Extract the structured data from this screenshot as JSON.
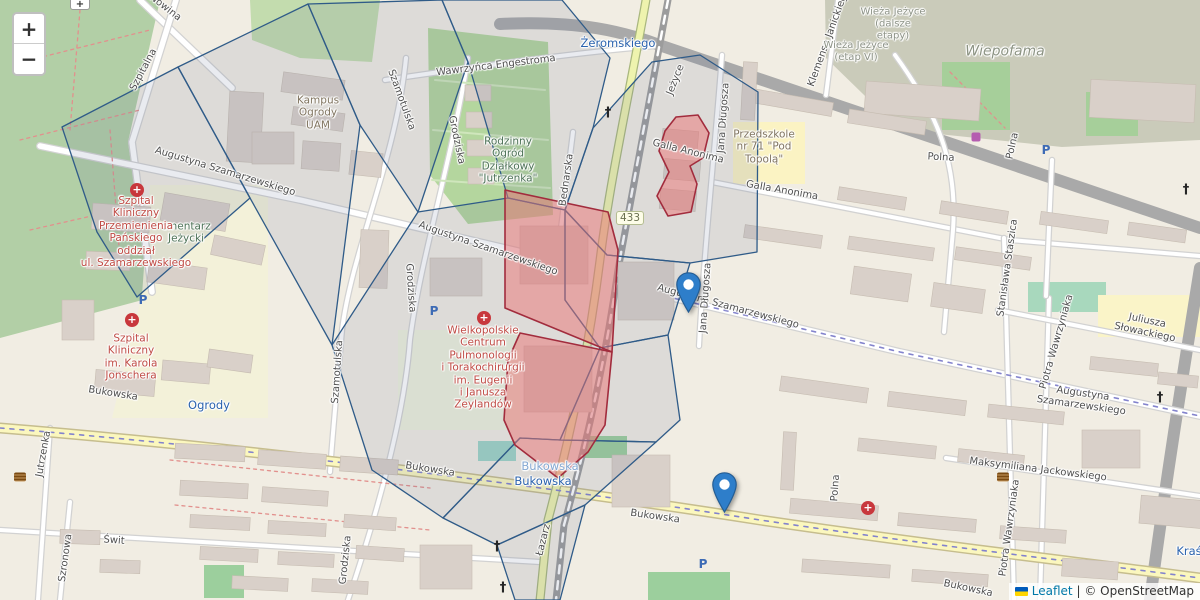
{
  "map": {
    "width": 1200,
    "height": 600
  },
  "controls": {
    "zoom_in_label": "+",
    "zoom_out_label": "−"
  },
  "attribution": {
    "flag_top": "#005bbb",
    "flag_bottom": "#ffd500",
    "leaflet_label": "Leaflet",
    "separator": "|",
    "copyright_label": "© OpenStreetMap"
  },
  "road_shield": {
    "text": "433",
    "x": 630,
    "y": 218
  },
  "markers": [
    {
      "name": "marker-szamarzewskiego",
      "x": 688,
      "y": 313,
      "fill": "#2e7eca",
      "stroke": "#255d93"
    },
    {
      "name": "marker-bukowska",
      "x": 724,
      "y": 513,
      "fill": "#2e7eca",
      "stroke": "#255d93"
    }
  ],
  "overlays": {
    "cell_stroke": "#2f5b88",
    "cell_fill": "rgba(96,116,146,0.14)",
    "cells": [
      "62,127 178,67 250,198 137,297 97,232",
      "178,67 308,4 360,125 332,345 250,198",
      "308,4 442,0 468,62 418,212 360,125",
      "442,0 562,0 610,58 593,128 565,210 508,198 468,62",
      "593,128 652,62 700,55 758,92 757,252 690,263 607,255 565,210",
      "565,210 607,255 690,263 668,335 600,348 565,300",
      "332,345 418,212 508,198 565,210 565,300 600,348 560,440 520,438 443,518 372,470",
      "520,438 560,440 656,442 585,505 497,545 443,518",
      "497,545 585,505 560,600 515,600",
      "656,442 680,420 668,335 600,348 560,440"
    ],
    "highlight_stroke": "#a22c3d",
    "highlight_fill": "rgba(235,115,115,0.5)",
    "highlights": [
      "676,117 698,115 709,133 703,158 690,166 697,184 691,212 668,216 657,196 669,172 659,151 665,131",
      "505,190 608,212 618,250 612,352 505,308",
      "520,333 612,352 605,425 588,452 558,478 515,445 504,420 508,360"
    ]
  },
  "labels": [
    {
      "t": "Nowina",
      "x": 165,
      "y": 8,
      "r": 38,
      "c": "st"
    },
    {
      "t": "Szpitalna",
      "x": 144,
      "y": 70,
      "r": -62,
      "c": "st"
    },
    {
      "t": "cmentarz\nJeżycki",
      "x": 186,
      "y": 233,
      "r": 0,
      "c": "ag"
    },
    {
      "t": "Kampus\nOgrody\nUAM",
      "x": 318,
      "y": 113,
      "r": 0,
      "c": "ab"
    },
    {
      "t": "Augustyna Szamarzewskiego",
      "x": 225,
      "y": 172,
      "r": 17,
      "c": "st"
    },
    {
      "t": "Augustyna Szamarzewskiego",
      "x": 488,
      "y": 249,
      "r": 19,
      "c": "st"
    },
    {
      "t": "Augustyna Szamarzewskiego",
      "x": 728,
      "y": 307,
      "r": 15,
      "c": "st"
    },
    {
      "t": "Augustyna Szamarzewskiego",
      "x": 1082,
      "y": 400,
      "r": 8,
      "c": "st"
    },
    {
      "t": "Wawrzyńca Engestroma",
      "x": 496,
      "y": 66,
      "r": -7,
      "c": "st"
    },
    {
      "t": "Grodziska",
      "x": 456,
      "y": 140,
      "r": 78,
      "c": "st"
    },
    {
      "t": "Grodziska",
      "x": 410,
      "y": 288,
      "r": 86,
      "c": "st"
    },
    {
      "t": "Grodziska",
      "x": 346,
      "y": 560,
      "r": -84,
      "c": "st"
    },
    {
      "t": "Szamotulska",
      "x": 401,
      "y": 100,
      "r": 70,
      "c": "st"
    },
    {
      "t": "Szamotulska",
      "x": 338,
      "y": 372,
      "r": -86,
      "c": "st"
    },
    {
      "t": "Rodzinny\nOgród\nDziałkowy\n\"Jutrzenka\"",
      "x": 508,
      "y": 160,
      "r": 0,
      "c": "ag"
    },
    {
      "t": "Bednarska",
      "x": 567,
      "y": 180,
      "r": -82,
      "c": "st"
    },
    {
      "t": "Żeromskiego",
      "x": 618,
      "y": 44,
      "r": 0,
      "c": "tr"
    },
    {
      "t": "Jeżyce",
      "x": 676,
      "y": 80,
      "r": -68,
      "c": "st"
    },
    {
      "t": "Galla Anonima",
      "x": 688,
      "y": 152,
      "r": 14,
      "c": "st"
    },
    {
      "t": "Galla Anonima",
      "x": 782,
      "y": 191,
      "r": 10,
      "c": "st"
    },
    {
      "t": "Jana Długosza",
      "x": 724,
      "y": 118,
      "r": -86,
      "c": "st"
    },
    {
      "t": "Jana Długosza",
      "x": 706,
      "y": 298,
      "r": -86,
      "c": "st"
    },
    {
      "t": "Przedszkole\nnr 71 \"Pod\nTopolą\"",
      "x": 764,
      "y": 147,
      "r": 0,
      "c": "ab"
    },
    {
      "t": "Klemensa Janickiego",
      "x": 829,
      "y": 38,
      "r": -70,
      "c": "st"
    },
    {
      "t": "Wieża Jeżyce\n(dalsze\netapy)",
      "x": 893,
      "y": 24,
      "r": 0,
      "c": "agr"
    },
    {
      "t": "Wieża Jeżyce\n(etap VI)",
      "x": 856,
      "y": 52,
      "r": 0,
      "c": "agr"
    },
    {
      "t": "Wiepofama",
      "x": 1005,
      "y": 52,
      "r": 0,
      "c": "ind"
    },
    {
      "t": "Polna",
      "x": 941,
      "y": 158,
      "r": 3,
      "c": "st"
    },
    {
      "t": "Polna",
      "x": 1013,
      "y": 146,
      "r": -78,
      "c": "st"
    },
    {
      "t": "Polna",
      "x": 836,
      "y": 488,
      "r": -86,
      "c": "st"
    },
    {
      "t": "Juliusza Słowackiego",
      "x": 1146,
      "y": 327,
      "r": 12,
      "c": "st"
    },
    {
      "t": "Piotra Wawrzyniaka",
      "x": 1057,
      "y": 342,
      "r": -74,
      "c": "st"
    },
    {
      "t": "Piotra Wawrzyniaka",
      "x": 1010,
      "y": 528,
      "r": -82,
      "c": "st"
    },
    {
      "t": "Stanisława Staszica",
      "x": 1008,
      "y": 268,
      "r": -82,
      "c": "st"
    },
    {
      "t": "Maksymiliana Jackowskiego",
      "x": 1038,
      "y": 470,
      "r": 7,
      "c": "st"
    },
    {
      "t": "Bukowska",
      "x": 113,
      "y": 394,
      "r": 9,
      "c": "st"
    },
    {
      "t": "Bukowska",
      "x": 430,
      "y": 470,
      "r": 9,
      "c": "st"
    },
    {
      "t": "Bukowska",
      "x": 655,
      "y": 517,
      "r": 8,
      "c": "st"
    },
    {
      "t": "Bukowska",
      "x": 968,
      "y": 589,
      "r": 12,
      "c": "st"
    },
    {
      "t": "Bukowska",
      "x": 550,
      "y": 467,
      "r": 0,
      "c": "tr2"
    },
    {
      "t": "Bukowska",
      "x": 543,
      "y": 482,
      "r": 0,
      "c": "tr"
    },
    {
      "t": "Ogrody",
      "x": 209,
      "y": 406,
      "r": 0,
      "c": "tr"
    },
    {
      "t": "Kraś",
      "x": 1189,
      "y": 552,
      "r": 0,
      "c": "tr"
    },
    {
      "t": "Świt",
      "x": 114,
      "y": 541,
      "r": 4,
      "c": "st"
    },
    {
      "t": "Szronowa",
      "x": 66,
      "y": 558,
      "r": -82,
      "c": "st"
    },
    {
      "t": "Jutrzenka",
      "x": 44,
      "y": 454,
      "r": -80,
      "c": "st"
    },
    {
      "t": "Łazarz",
      "x": 544,
      "y": 540,
      "r": -76,
      "c": "st"
    },
    {
      "t": "Szpital\nKliniczny\nPrzemienienia\nPańskiego\noddział\nul. Szamarzewskiego",
      "x": 136,
      "y": 232,
      "r": 0,
      "c": "hosp"
    },
    {
      "t": "Szpital\nKliniczny\nim. Karola\nJonschera",
      "x": 131,
      "y": 357,
      "r": 0,
      "c": "hosp"
    },
    {
      "t": "Wielkopolskie\nCentrum\nPulmonologii\ni Torakochirurgii\nim. Eugenii\ni Janusza\nZeylandów",
      "x": 483,
      "y": 368,
      "r": 0,
      "c": "hosp"
    }
  ],
  "poi": [
    {
      "type": "hospital",
      "glyph": "+",
      "x": 137,
      "y": 190
    },
    {
      "type": "hospital",
      "glyph": "+",
      "x": 132,
      "y": 320
    },
    {
      "type": "hospital",
      "glyph": "+",
      "x": 484,
      "y": 318
    },
    {
      "type": "hospital",
      "glyph": "+",
      "x": 868,
      "y": 508
    },
    {
      "type": "parking",
      "glyph": "P",
      "x": 143,
      "y": 300
    },
    {
      "type": "parking",
      "glyph": "P",
      "x": 434,
      "y": 311
    },
    {
      "type": "parking",
      "glyph": "P",
      "x": 703,
      "y": 564
    },
    {
      "type": "parking",
      "glyph": "P",
      "x": 1046,
      "y": 150
    },
    {
      "type": "church",
      "glyph": "†",
      "x": 608,
      "y": 113
    },
    {
      "type": "church",
      "glyph": "†",
      "x": 497,
      "y": 547
    },
    {
      "type": "church",
      "glyph": "†",
      "x": 503,
      "y": 588
    },
    {
      "type": "church",
      "glyph": "†",
      "x": 1160,
      "y": 398
    },
    {
      "type": "church",
      "glyph": "†",
      "x": 1186,
      "y": 190
    },
    {
      "type": "library",
      "glyph": "",
      "x": 20,
      "y": 477
    },
    {
      "type": "library",
      "glyph": "",
      "x": 1003,
      "y": 477
    },
    {
      "type": "shop",
      "glyph": "",
      "x": 976,
      "y": 137
    }
  ],
  "basemap": {
    "land": "#f1ede3",
    "areas": [
      {
        "pts": "0,0 160,0 128,142 150,298 60,322 0,338",
        "f": "#b2cfa6"
      },
      {
        "pts": "250,0 380,0 372,62 300,58 252,40",
        "f": "#c3dcae"
      },
      {
        "pts": "150,185 268,185 268,418 112,418 142,295",
        "f": "#f3f1d9"
      },
      {
        "pts": "428,28 548,42 553,215 468,224 430,175",
        "f": "#b4d69e"
      },
      {
        "pts": "398,330 520,330 520,430 398,430",
        "f": "#eef2dc"
      },
      {
        "pts": "825,0 1200,0 1200,140 1062,147 900,130 826,58",
        "f": "#cacbba"
      },
      {
        "rect": [
          942,
          62,
          68,
          68
        ],
        "f": "#a6cf9a"
      },
      {
        "rect": [
          1086,
          92,
          52,
          44
        ],
        "f": "#a6cf9a"
      },
      {
        "rect": [
          1028,
          282,
          78,
          30
        ],
        "f": "#a8d8bd"
      },
      {
        "rect": [
          733,
          122,
          72,
          62
        ],
        "f": "#fbf3c3"
      },
      {
        "rect": [
          1098,
          295,
          102,
          42
        ],
        "f": "#faf4c8"
      },
      {
        "rect": [
          583,
          436,
          44,
          22
        ],
        "f": "#9ccf9d"
      },
      {
        "rect": [
          478,
          441,
          38,
          20
        ],
        "f": "#9fd4c6"
      },
      {
        "rect": [
          204,
          565,
          40,
          33
        ],
        "f": "#9ccf9d"
      },
      {
        "rect": [
          648,
          572,
          82,
          28
        ],
        "f": "#9ccf9d"
      }
    ],
    "roads": [
      {
        "d": "M 500,24 C 580,20 625,32 662,46 L 1200,228",
        "t": "trunk"
      },
      {
        "d": "M 1200,268 C 1182,380 1166,480 1150,600",
        "t": "trunk"
      },
      {
        "d": "M 140,0 L 232,88",
        "t": "minor"
      },
      {
        "d": "M 176,0 L 132,142 L 152,292",
        "t": "minor"
      },
      {
        "d": "M 385,80 C 480,66 580,52 656,46",
        "t": "minor5"
      },
      {
        "d": "M 40,146 L 300,200 L 522,252",
        "t": "minor"
      },
      {
        "d": "M 656,294 L 900,352 L 1200,416",
        "t": "minor"
      },
      {
        "d": "M 712,182 L 1010,240 L 1200,256",
        "t": "minor5"
      },
      {
        "d": "M 722,55 C 714,160 704,250 699,346",
        "t": "minor5"
      },
      {
        "d": "M 468,58 C 452,160 420,260 410,340 C 404,420 375,520 348,600",
        "t": "minor5"
      },
      {
        "d": "M 406,58 C 396,160 352,250 342,330 C 336,400 332,440 330,472",
        "t": "minor5"
      },
      {
        "d": "M 573,132 L 561,228",
        "t": "minor5"
      },
      {
        "d": "M 895,55 C 935,110 958,160 953,230 L 944,332",
        "t": "minor5"
      },
      {
        "d": "M 1004,238 L 1014,600",
        "t": "minor5"
      },
      {
        "d": "M 1049,298 L 1040,600",
        "t": "minor5"
      },
      {
        "d": "M 998,310 L 1200,350",
        "t": "minor5"
      },
      {
        "d": "M 946,458 L 1200,496",
        "t": "minor5"
      },
      {
        "d": "M 0,530 L 540,562",
        "t": "minor5"
      },
      {
        "d": "M 70,502 L 60,600",
        "t": "minor5"
      },
      {
        "d": "M 50,428 L 38,600",
        "t": "minor5"
      },
      {
        "d": "M 838,0 L 826,95",
        "t": "minor5"
      },
      {
        "d": "M 1052,160 L 1046,296",
        "t": "minor5"
      },
      {
        "d": "M 0,428 C 300,452 620,498 760,520 C 950,548 1080,562 1200,578",
        "t": "yellow"
      },
      {
        "d": "M 646,0 C 630,90 610,180 600,260 C 590,340 572,430 548,520 L 540,600",
        "t": "r433"
      },
      {
        "d": "M 668,0 C 650,95 632,190 618,270 C 606,355 590,430 564,525 L 556,600",
        "t": "rail"
      },
      {
        "d": "M 0,428 C 300,452 620,498 760,520 C 950,548 1080,562 1200,578",
        "t": "tram"
      },
      {
        "d": "M 656,294 L 900,352 L 1200,416",
        "t": "tram"
      },
      {
        "d": "M 30,60 L 150,30",
        "t": "reddash"
      },
      {
        "d": "M 20,140 L 140,110",
        "t": "reddash"
      },
      {
        "d": "M 30,230 L 140,205",
        "t": "reddash"
      },
      {
        "d": "M 80,10 L 70,130",
        "t": "reddash"
      },
      {
        "d": "M 110,130 L 120,260",
        "t": "reddash"
      },
      {
        "d": "M 170,460 L 430,488",
        "t": "reddash"
      },
      {
        "d": "M 175,505 L 430,530",
        "t": "reddash"
      },
      {
        "d": "M 950,72 L 1005,128",
        "t": "reddash"
      },
      {
        "d": "M 435,80 L 545,90",
        "t": "greenline"
      },
      {
        "d": "M 433,130 L 548,140",
        "t": "greenline"
      },
      {
        "d": "M 432,180 L 550,188",
        "t": "greenline"
      }
    ],
    "buildings": [
      [
        92,
        205,
        58,
        26,
        4
      ],
      [
        162,
        198,
        66,
        28,
        10
      ],
      [
        212,
        240,
        52,
        20,
        12
      ],
      [
        86,
        252,
        44,
        18,
        2
      ],
      [
        148,
        264,
        58,
        22,
        8
      ],
      [
        228,
        92,
        34,
        70,
        3
      ],
      [
        62,
        300,
        32,
        40,
        0
      ],
      [
        95,
        372,
        60,
        22,
        5
      ],
      [
        162,
        362,
        48,
        20,
        5
      ],
      [
        208,
        352,
        44,
        18,
        8
      ],
      [
        175,
        445,
        70,
        15,
        3
      ],
      [
        258,
        452,
        68,
        15,
        4
      ],
      [
        340,
        458,
        58,
        15,
        4
      ],
      [
        180,
        482,
        68,
        15,
        3
      ],
      [
        262,
        489,
        66,
        15,
        4
      ],
      [
        190,
        516,
        60,
        13,
        3
      ],
      [
        268,
        522,
        58,
        13,
        3
      ],
      [
        344,
        516,
        52,
        13,
        4
      ],
      [
        200,
        548,
        58,
        13,
        3
      ],
      [
        278,
        553,
        56,
        13,
        3
      ],
      [
        356,
        547,
        48,
        13,
        4
      ],
      [
        232,
        577,
        56,
        13,
        3
      ],
      [
        312,
        580,
        56,
        13,
        3
      ],
      [
        60,
        530,
        40,
        14,
        2
      ],
      [
        100,
        560,
        40,
        13,
        2
      ],
      [
        282,
        76,
        62,
        20,
        8
      ],
      [
        292,
        110,
        52,
        18,
        8
      ],
      [
        252,
        132,
        42,
        32,
        0
      ],
      [
        302,
        142,
        38,
        28,
        4
      ],
      [
        350,
        152,
        32,
        24,
        6
      ],
      [
        360,
        230,
        28,
        58,
        2
      ],
      [
        430,
        258,
        52,
        38,
        0
      ],
      [
        465,
        85,
        26,
        16,
        0
      ],
      [
        466,
        112,
        26,
        16,
        0
      ],
      [
        467,
        140,
        26,
        16,
        0
      ],
      [
        468,
        168,
        26,
        16,
        0
      ],
      [
        520,
        226,
        68,
        58,
        0
      ],
      [
        524,
        346,
        68,
        66,
        0
      ],
      [
        618,
        262,
        56,
        58,
        0
      ],
      [
        612,
        455,
        58,
        52,
        0
      ],
      [
        420,
        545,
        52,
        44,
        0
      ],
      [
        662,
        130,
        36,
        20,
        5
      ],
      [
        664,
        160,
        36,
        20,
        5
      ],
      [
        660,
        190,
        36,
        20,
        5
      ],
      [
        865,
        85,
        115,
        32,
        4
      ],
      [
        1090,
        82,
        105,
        38,
        3
      ],
      [
        745,
        95,
        88,
        14,
        10
      ],
      [
        848,
        115,
        78,
        14,
        9
      ],
      [
        838,
        192,
        68,
        13,
        9
      ],
      [
        940,
        206,
        68,
        13,
        9
      ],
      [
        1040,
        216,
        68,
        13,
        8
      ],
      [
        1128,
        226,
        58,
        13,
        8
      ],
      [
        744,
        230,
        78,
        13,
        8
      ],
      [
        848,
        242,
        86,
        13,
        8
      ],
      [
        955,
        252,
        76,
        13,
        8
      ],
      [
        852,
        270,
        58,
        28,
        8
      ],
      [
        932,
        286,
        52,
        24,
        8
      ],
      [
        1090,
        360,
        68,
        13,
        6
      ],
      [
        1158,
        374,
        40,
        12,
        6
      ],
      [
        1082,
        430,
        58,
        38,
        0
      ],
      [
        1140,
        498,
        66,
        28,
        5
      ],
      [
        1062,
        560,
        56,
        18,
        4
      ],
      [
        780,
        382,
        88,
        15,
        8
      ],
      [
        888,
        396,
        78,
        15,
        7
      ],
      [
        988,
        408,
        76,
        13,
        6
      ],
      [
        782,
        432,
        13,
        58,
        3
      ],
      [
        858,
        442,
        78,
        13,
        6
      ],
      [
        958,
        452,
        66,
        13,
        6
      ],
      [
        790,
        502,
        88,
        15,
        5
      ],
      [
        898,
        516,
        78,
        13,
        5
      ],
      [
        1000,
        528,
        66,
        13,
        4
      ],
      [
        802,
        562,
        88,
        13,
        4
      ],
      [
        912,
        572,
        76,
        12,
        4
      ],
      [
        742,
        62,
        14,
        58,
        3
      ]
    ],
    "building_fill": "#d9d0c9",
    "building_stroke": "#c6bcb1"
  }
}
